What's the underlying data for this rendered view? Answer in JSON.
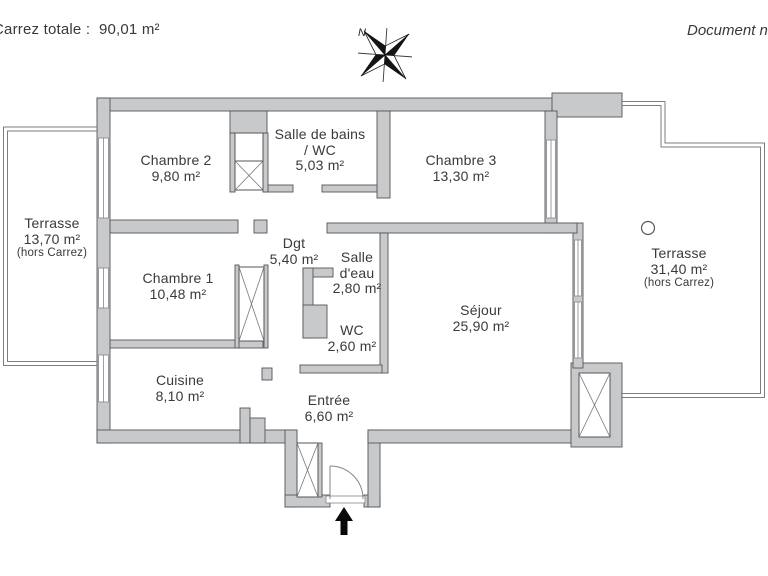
{
  "header": {
    "left_text": "Carrez totale :  90,01 m²",
    "right_text": "Document n"
  },
  "compass": {
    "north_label": "N"
  },
  "rooms": {
    "terrasse_left": {
      "name": "Terrasse",
      "area": "13,70 m²",
      "note": "(hors Carrez)"
    },
    "chambre2": {
      "name": "Chambre 2",
      "area": "9,80 m²"
    },
    "sdb": {
      "line1": "Salle de bains",
      "line2": "/ WC",
      "area": "5,03 m²"
    },
    "chambre3": {
      "name": "Chambre 3",
      "area": "13,30 m²"
    },
    "chambre1": {
      "name": "Chambre 1",
      "area": "10,48 m²"
    },
    "dgt": {
      "name": "Dgt",
      "area": "5,40 m²"
    },
    "salle_eau": {
      "line1": "Salle",
      "line2": "d'eau",
      "area": "2,80 m²"
    },
    "wc": {
      "name": "WC",
      "area": "2,60 m²"
    },
    "sejour": {
      "name": "Séjour",
      "area": "25,90 m²"
    },
    "terrasse_right": {
      "name": "Terrasse",
      "area": "31,40 m²",
      "note": "(hors Carrez)"
    },
    "cuisine": {
      "name": "Cuisine",
      "area": "8,10 m²"
    },
    "entree": {
      "name": "Entrée",
      "area": "6,60 m²"
    }
  }
}
